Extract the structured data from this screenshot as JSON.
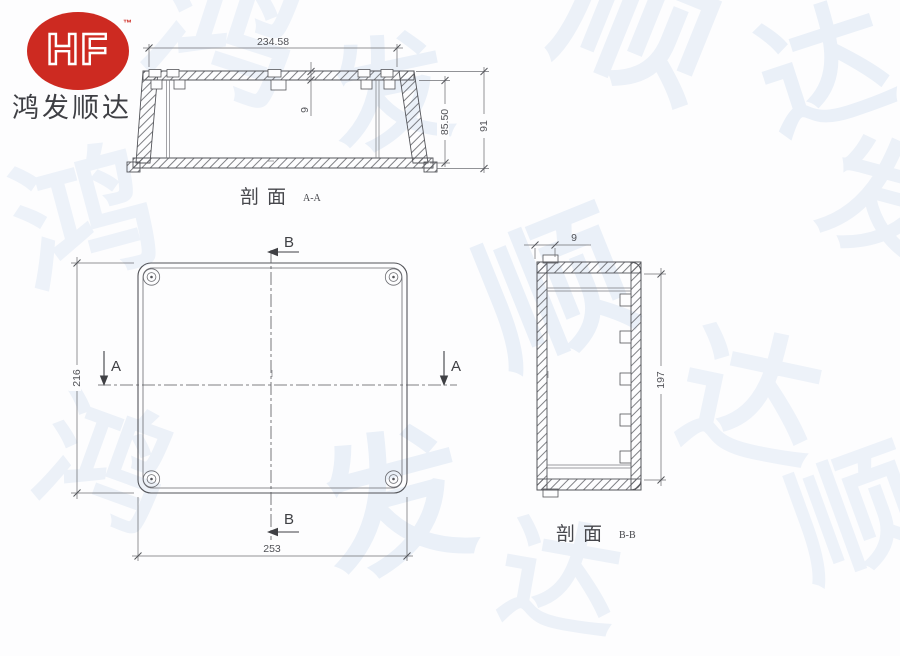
{
  "logo": {
    "brand": "HF",
    "trademark": "™",
    "company": "鸿发顺达",
    "red": "#cd2a21",
    "text_color": "#3e3f44"
  },
  "watermark": {
    "chars": [
      "鸿",
      "发",
      "顺",
      "达",
      "鸿",
      "发",
      "顺",
      "达",
      "鸿",
      "发",
      "顺",
      "达"
    ]
  },
  "views": {
    "section_aa": {
      "label": "剖面",
      "label_suffix": "A-A",
      "dim_width": "234.58",
      "dim_wall": "9",
      "dim_inner_height": "85.50",
      "dim_outer_height": "91"
    },
    "plan": {
      "dim_height": "216",
      "dim_width": "253",
      "marker_a": "A",
      "marker_b": "B"
    },
    "section_bb": {
      "label": "剖面",
      "label_suffix": "B-B",
      "dim_wall": "9",
      "dim_inner_height": "197"
    }
  },
  "drawing": {
    "line_color": "#54555a",
    "dim_color": "#6e6f74",
    "background": "#fdfdfe"
  }
}
